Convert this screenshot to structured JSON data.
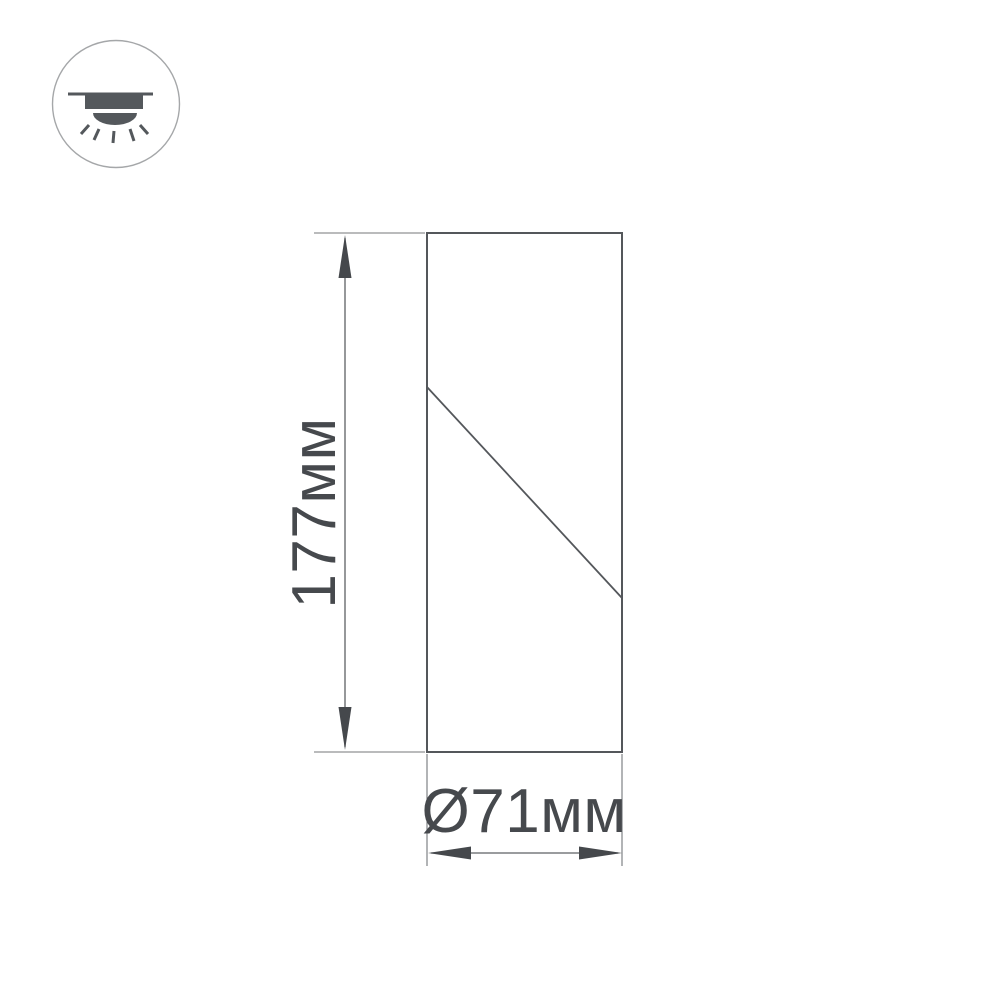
{
  "diagram": {
    "dimensions": {
      "height_label": "177мм",
      "diameter_label": "Ø71мм"
    },
    "icon": {
      "meaning": "surface-mounted-ceiling-light"
    }
  },
  "colors": {
    "background": "#ffffff",
    "outline": "#54575b",
    "dim-line": "#5e6164",
    "ext-line": "#74777a",
    "arrow": "#45484c",
    "text": "#46494d",
    "icon-fill": "#54585c",
    "icon-circle": "#a5a7a9"
  }
}
